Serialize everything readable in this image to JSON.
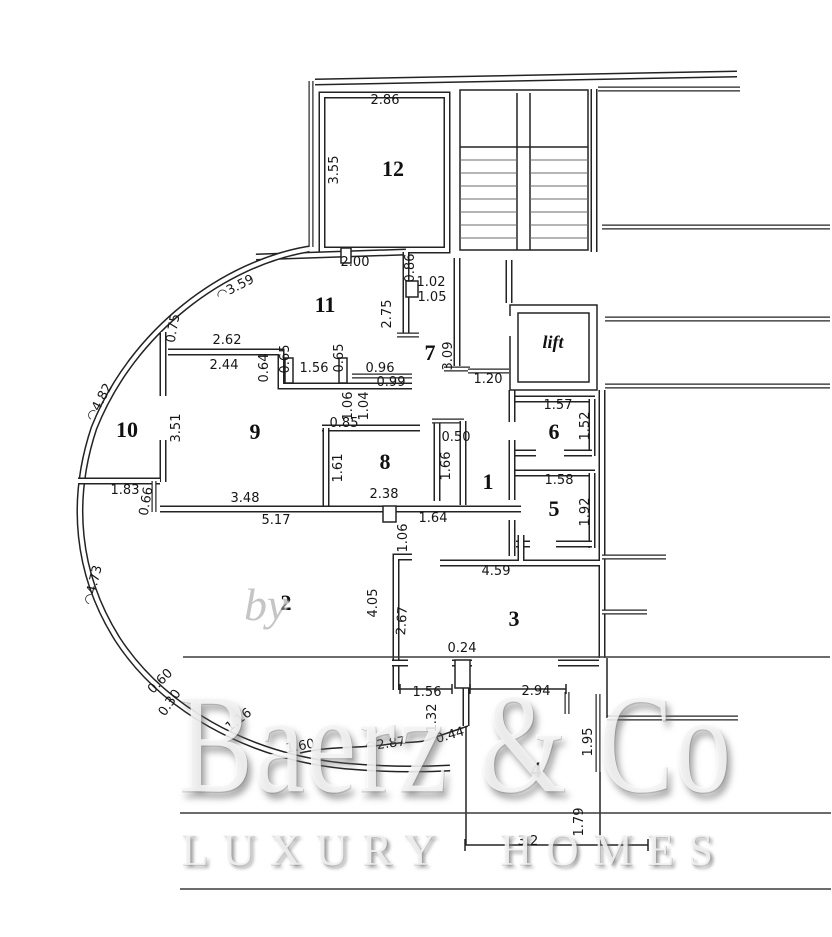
{
  "watermark": {
    "by": "by",
    "brand": "Baerz & Co",
    "tagline": "LUXURY HOMES"
  },
  "plan": {
    "rooms": [
      {
        "label": "12",
        "x": 393,
        "y": 176
      },
      {
        "label": "11",
        "x": 325,
        "y": 312
      },
      {
        "label": "7",
        "x": 430,
        "y": 360
      },
      {
        "label": "lift",
        "x": 553,
        "y": 348,
        "italic": true
      },
      {
        "label": "10",
        "x": 127,
        "y": 437
      },
      {
        "label": "9",
        "x": 255,
        "y": 439
      },
      {
        "label": "8",
        "x": 385,
        "y": 469
      },
      {
        "label": "1",
        "x": 488,
        "y": 489
      },
      {
        "label": "6",
        "x": 554,
        "y": 439
      },
      {
        "label": "5",
        "x": 554,
        "y": 516
      },
      {
        "label": "2",
        "x": 286,
        "y": 610
      },
      {
        "label": "3",
        "x": 514,
        "y": 626
      },
      {
        "label": "4",
        "x": 536,
        "y": 777
      }
    ],
    "dimensions": [
      {
        "text": "2.86",
        "x": 385,
        "y": 104,
        "rot": 0
      },
      {
        "text": "3.55",
        "x": 338,
        "y": 170,
        "rot": -90
      },
      {
        "text": "2.00",
        "x": 355,
        "y": 266,
        "rot": 0
      },
      {
        "text": "0.86",
        "x": 414,
        "y": 268,
        "rot": -90
      },
      {
        "text": "1.02",
        "x": 431,
        "y": 286,
        "rot": 0
      },
      {
        "text": "1.05",
        "x": 432,
        "y": 301,
        "rot": 0
      },
      {
        "text": "◠3.59",
        "x": 237,
        "y": 291,
        "rot": -27
      },
      {
        "text": "2.75",
        "x": 391,
        "y": 314,
        "rot": -90
      },
      {
        "text": "0.75",
        "x": 177,
        "y": 329,
        "rot": -80
      },
      {
        "text": "2.62",
        "x": 227,
        "y": 344,
        "rot": 0
      },
      {
        "text": "2.44",
        "x": 224,
        "y": 369,
        "rot": 0
      },
      {
        "text": "0.64",
        "x": 268,
        "y": 368,
        "rot": -90
      },
      {
        "text": "0.65",
        "x": 289,
        "y": 359,
        "rot": -90
      },
      {
        "text": "1.56",
        "x": 314,
        "y": 372,
        "rot": 0
      },
      {
        "text": "0.65",
        "x": 343,
        "y": 358,
        "rot": -90
      },
      {
        "text": "0.96",
        "x": 380,
        "y": 372,
        "rot": 0
      },
      {
        "text": "3.09",
        "x": 452,
        "y": 356,
        "rot": -90
      },
      {
        "text": "0.99",
        "x": 391,
        "y": 386,
        "rot": 0
      },
      {
        "text": "1.20",
        "x": 488,
        "y": 383,
        "rot": 0
      },
      {
        "text": "1.06",
        "x": 352,
        "y": 406,
        "rot": -90
      },
      {
        "text": "1.04",
        "x": 368,
        "y": 406,
        "rot": -90
      },
      {
        "text": "1.57",
        "x": 558,
        "y": 409,
        "rot": 0
      },
      {
        "text": "0.85",
        "x": 344,
        "y": 427,
        "rot": 0
      },
      {
        "text": "1.52",
        "x": 589,
        "y": 426,
        "rot": -90
      },
      {
        "text": "3.51",
        "x": 180,
        "y": 428,
        "rot": -90
      },
      {
        "text": "0.50",
        "x": 456,
        "y": 441,
        "rot": 0
      },
      {
        "text": "1.61",
        "x": 342,
        "y": 468,
        "rot": -90
      },
      {
        "text": "1.66",
        "x": 450,
        "y": 466,
        "rot": -90
      },
      {
        "text": "1.58",
        "x": 559,
        "y": 484,
        "rot": 0
      },
      {
        "text": "1.92",
        "x": 589,
        "y": 512,
        "rot": -90
      },
      {
        "text": "1.83",
        "x": 125,
        "y": 494,
        "rot": 0
      },
      {
        "text": "0.66",
        "x": 150,
        "y": 502,
        "rot": -80
      },
      {
        "text": "3.48",
        "x": 245,
        "y": 502,
        "rot": 0
      },
      {
        "text": "2.38",
        "x": 384,
        "y": 498,
        "rot": 0
      },
      {
        "text": "5.17",
        "x": 276,
        "y": 524,
        "rot": 0
      },
      {
        "text": "1.64",
        "x": 433,
        "y": 522,
        "rot": 0
      },
      {
        "text": "1.06",
        "x": 407,
        "y": 538,
        "rot": -90
      },
      {
        "text": "◠4.82",
        "x": 103,
        "y": 404,
        "rot": -62
      },
      {
        "text": "◠4.73",
        "x": 97,
        "y": 586,
        "rot": -76
      },
      {
        "text": "4.59",
        "x": 496,
        "y": 575,
        "rot": 0
      },
      {
        "text": "4.05",
        "x": 377,
        "y": 603,
        "rot": -90
      },
      {
        "text": "2.67",
        "x": 406,
        "y": 621,
        "rot": -86
      },
      {
        "text": "0.24",
        "x": 462,
        "y": 652,
        "rot": 0
      },
      {
        "text": "1.56",
        "x": 427,
        "y": 696,
        "rot": 0
      },
      {
        "text": "2.94",
        "x": 536,
        "y": 695,
        "rot": 0
      },
      {
        "text": "1.32",
        "x": 436,
        "y": 718,
        "rot": -90
      },
      {
        "text": "1.95",
        "x": 592,
        "y": 742,
        "rot": -90
      },
      {
        "text": "0.60",
        "x": 163,
        "y": 684,
        "rot": -45
      },
      {
        "text": "0.30",
        "x": 173,
        "y": 705,
        "rot": -55
      },
      {
        "text": "1.16",
        "x": 241,
        "y": 723,
        "rot": -38
      },
      {
        "text": "1.60",
        "x": 301,
        "y": 750,
        "rot": -10
      },
      {
        "text": "◠2.87",
        "x": 386,
        "y": 748,
        "rot": -8
      },
      {
        "text": "0.44",
        "x": 451,
        "y": 739,
        "rot": -16
      },
      {
        "text": "1.79",
        "x": 583,
        "y": 822,
        "rot": -90
      },
      {
        "text": "3.2",
        "x": 528,
        "y": 845,
        "rot": 0
      }
    ]
  }
}
